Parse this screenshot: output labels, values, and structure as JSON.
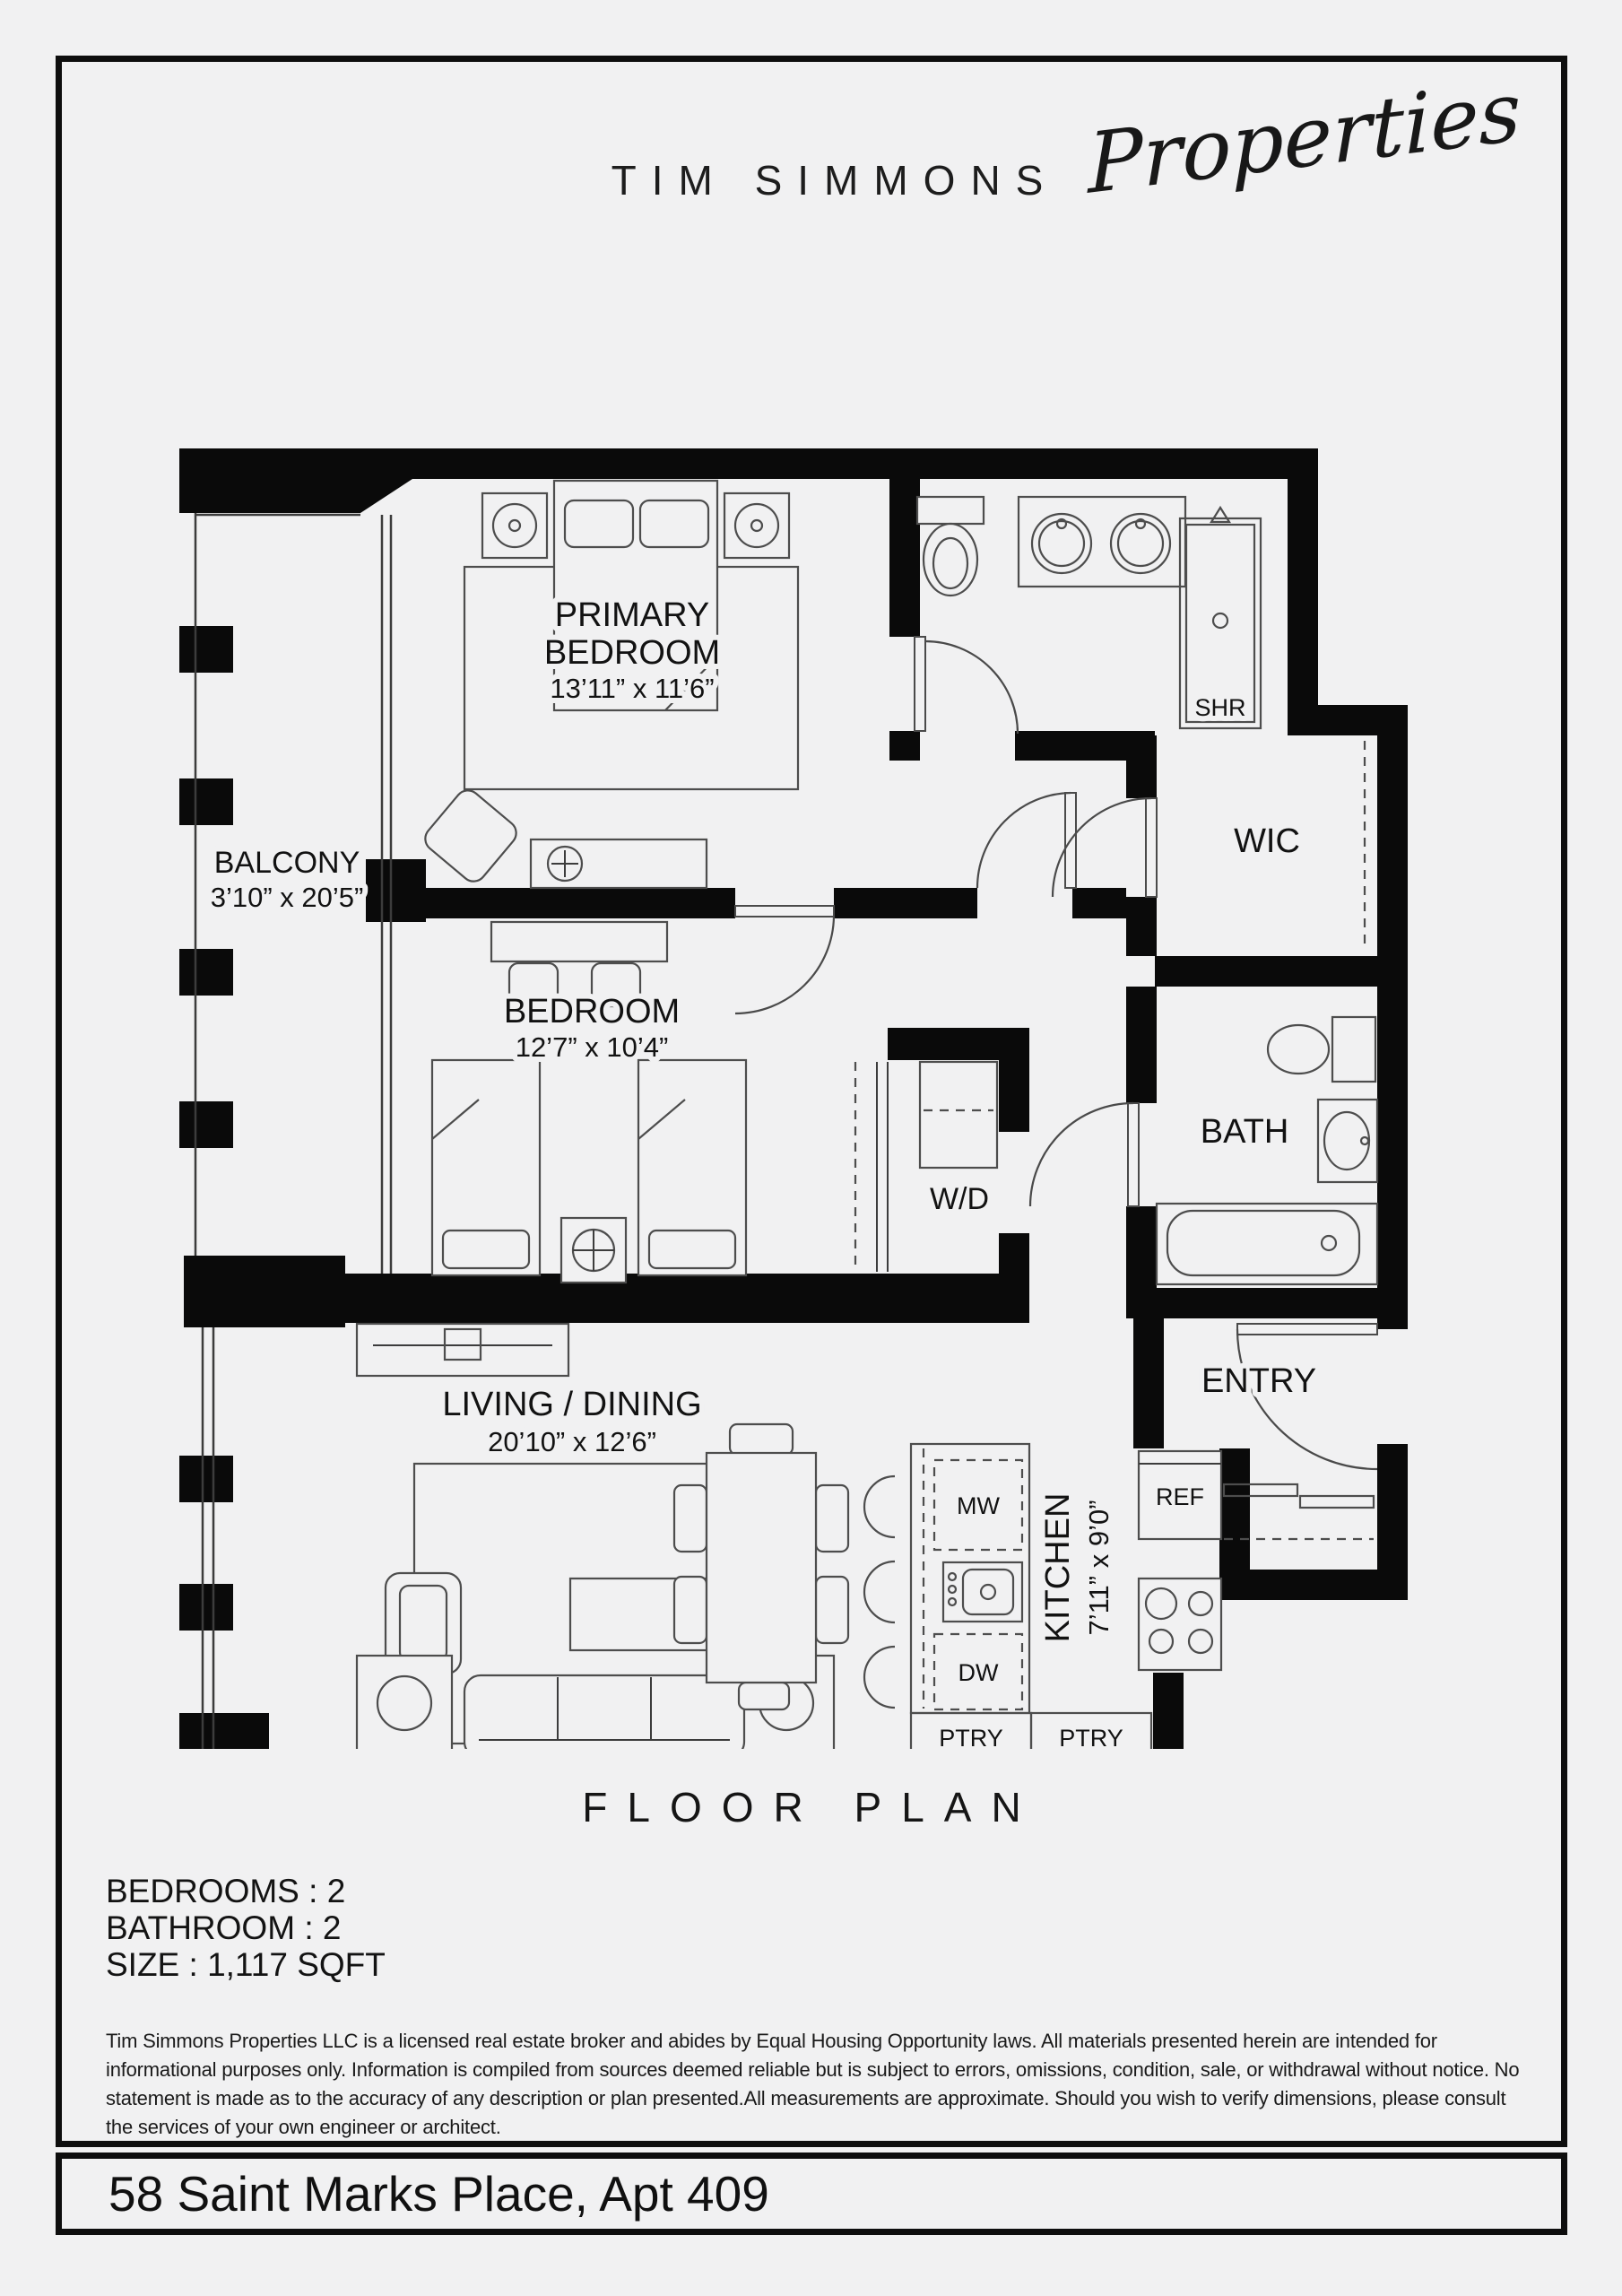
{
  "brand": {
    "name": "TIM SIMMONS",
    "script": "Properties"
  },
  "plan": {
    "rooms": {
      "primary_bedroom": {
        "line1": "PRIMARY",
        "line2": "BEDROOM",
        "dims": "13’11” x 11’6”"
      },
      "bedroom": {
        "line1": "BEDROOM",
        "dims": "12’7” x 10’4”"
      },
      "balcony": {
        "line1": "BALCONY",
        "dims": "3’10” x 20’5”"
      },
      "living_dining": {
        "line1": "LIVING / DINING",
        "dims": "20’10” x 12’6”"
      },
      "kitchen": {
        "line1": "KITCHEN",
        "dims": "7’11” x 9’0”"
      },
      "entry": {
        "line1": "ENTRY"
      },
      "bath": {
        "line1": "BATH"
      },
      "wic": {
        "line1": "WIC"
      },
      "shower": {
        "line1": "SHR"
      },
      "washer_dryer": {
        "line1": "W/D"
      }
    },
    "fixtures": {
      "microwave": "MW",
      "dishwasher": "DW",
      "refrigerator": "REF",
      "pantry_left": "PTRY",
      "pantry_right": "PTRY"
    }
  },
  "title": "FLOOR PLAN",
  "details": {
    "bedrooms": "BEDROOMS : 2",
    "bathroom": "BATHROOM : 2",
    "size": "SIZE : 1,117 SQFT"
  },
  "disclaimer": "Tim Simmons Properties LLC is a licensed real estate broker and abides by Equal Housing Opportunity laws. All materials presented herein are intended for informational purposes only. Information is compiled from sources deemed reliable but is subject to errors, omissions, condition, sale, or withdrawal without notice. No statement is made as to the accuracy of any description or plan presented.All measurements are approximate. Should you wish to verify dimensions, please consult the services of your own engineer or architect.",
  "footer": {
    "address": "58 Saint Marks Place, Apt 409"
  },
  "colors": {
    "background": "#f1f1f2",
    "wall": "#0a0a0a",
    "line": "#4d4d4d",
    "text": "#141414"
  }
}
